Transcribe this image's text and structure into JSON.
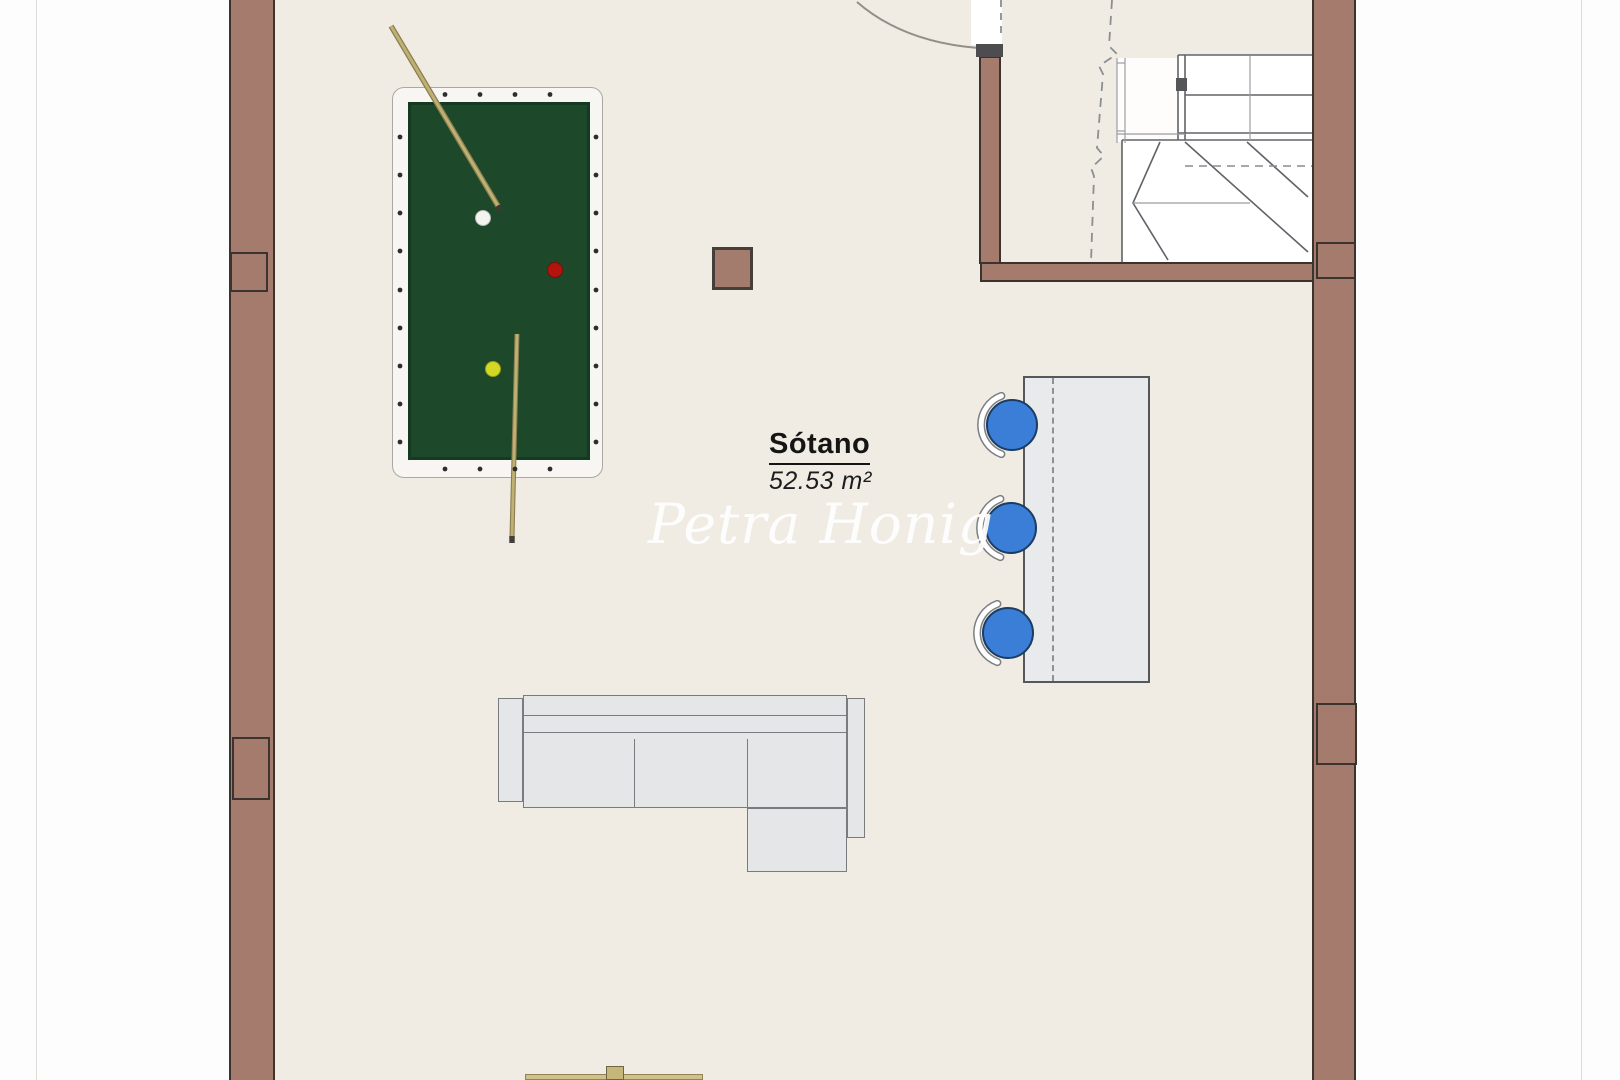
{
  "room": {
    "label": "Sótano",
    "area": "52.53 m²"
  },
  "watermark": {
    "text": "Petra Honig"
  },
  "colors": {
    "wall": "#a47b6d",
    "floor": "#f0ece3",
    "felt": "#1d4829",
    "stool": "#3a7ed8",
    "counter": "#e9eaeb",
    "sofa": "#e4e6e8",
    "cue": "#bfb173",
    "stair_line": "#606368"
  }
}
